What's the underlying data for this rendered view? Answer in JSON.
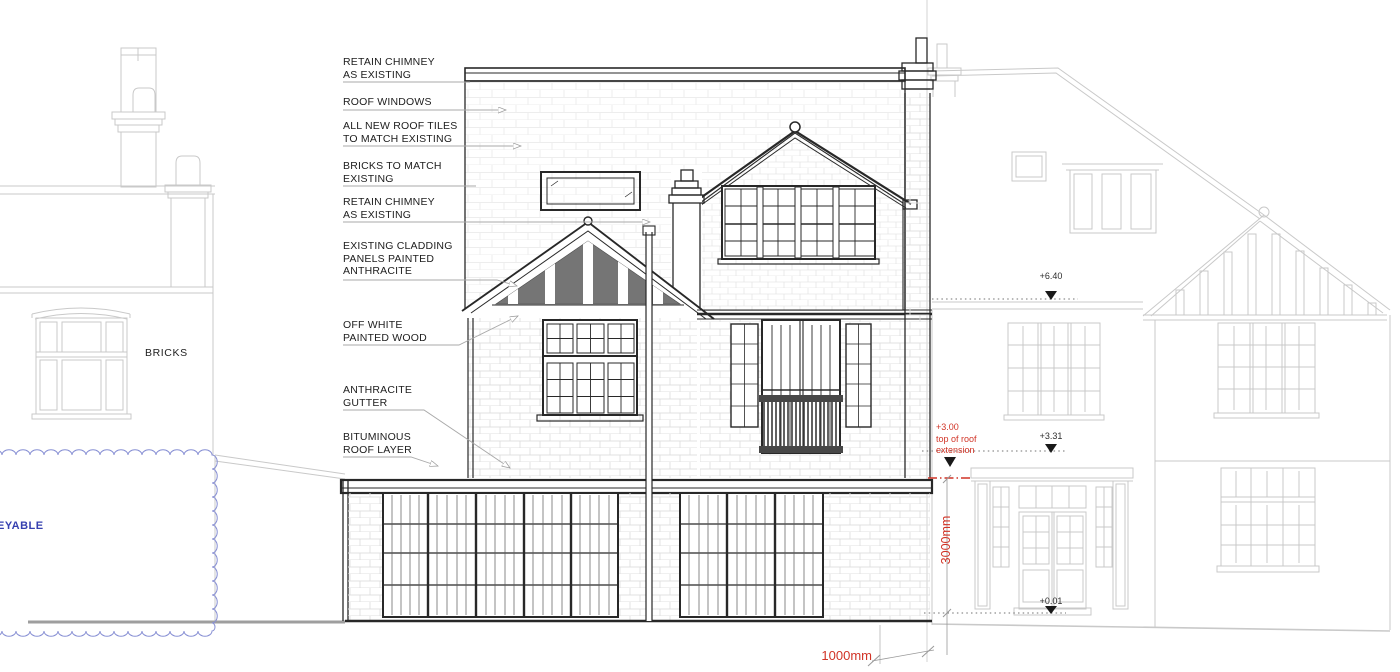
{
  "drawing": {
    "callouts": [
      "RETAIN CHIMNEY\nAS EXISTING",
      "ROOF WINDOWS",
      "ALL NEW ROOF TILES\nTO MATCH EXISTING",
      "BRICKS TO MATCH\nEXISTING",
      "RETAIN CHIMNEY\nAS EXISTING",
      "EXISTING CLADDING\nPANELS PAINTED\nANTHRACITE",
      "OFF WHITE\nPAINTED WOOD",
      "ANTHRACITE\nGUTTER",
      "BITUMINOUS\nROOF LAYER"
    ],
    "material_label": "BRICKS",
    "revision_text": "EYABLE",
    "levels": {
      "eaves": "+6.40",
      "porch": "+3.31",
      "ground": "+0.01"
    },
    "roof_extension_note": "+3.00\ntop of roof\nextension",
    "dim_vertical": "3000mm",
    "dim_horizontal": "1000mm",
    "colors": {
      "line_dark": "#282828",
      "line_light": "#c9c9c9",
      "annotation_red": "#d13427",
      "revision_blue": "#3640b0",
      "cladding_anthracite": "#757575"
    }
  }
}
